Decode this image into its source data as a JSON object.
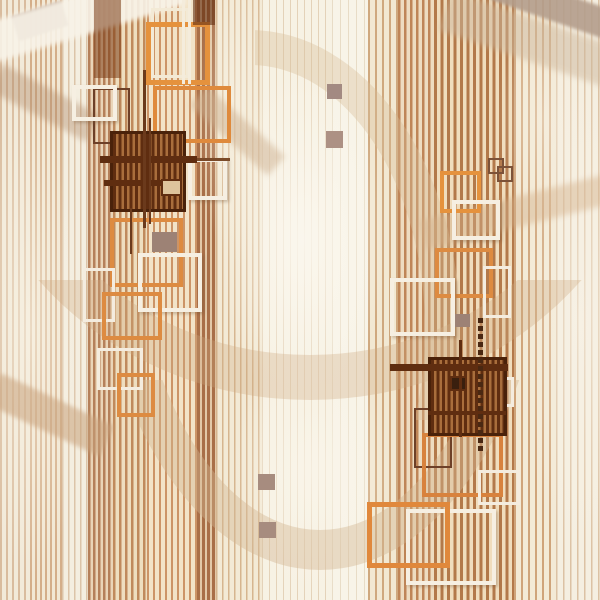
{
  "meta": {
    "title": "abstract-geometric-stripe-pattern",
    "width": 600,
    "height": 600,
    "background": "#f2e9d8"
  },
  "palette": {
    "cream": "#f2e9d8",
    "orange_frame": "#e0883c",
    "white_frame": "#f6efe2",
    "dark_brown": "#5f2d10",
    "plaid_stripe_a": "#5f2d10",
    "plaid_stripe_b": "#a96e3c",
    "plaid_border": "#4a220a",
    "taupe": "#a18878"
  },
  "stripes": [
    {
      "x": 0,
      "w": 30,
      "period": 6,
      "sw": 2,
      "stripe": "#d9bc9e",
      "base": "#f2ead9"
    },
    {
      "x": 30,
      "w": 32,
      "period": 5,
      "sw": 2,
      "stripe": "#d4ae89",
      "base": "#f2e8d4"
    },
    {
      "x": 62,
      "w": 26,
      "period": 6,
      "sw": 1.5,
      "stripe": "#dcc4a8",
      "base": "#f4eee0"
    },
    {
      "x": 88,
      "w": 25,
      "period": 5,
      "sw": 2.5,
      "stripe": "#b5805a",
      "base": "#ead5b8"
    },
    {
      "x": 113,
      "w": 34,
      "period": 6,
      "sw": 2.5,
      "stripe": "#c08a5c",
      "base": "#eedebf"
    },
    {
      "x": 147,
      "w": 50,
      "period": 6,
      "sw": 2,
      "stripe": "#cc9467",
      "base": "#f2e3c8"
    },
    {
      "x": 197,
      "w": 19,
      "period": 5,
      "sw": 3,
      "stripe": "#a96f48",
      "base": "#e3c9a8"
    },
    {
      "x": 216,
      "w": 46,
      "period": 6,
      "sw": 1.5,
      "stripe": "#d6b58f",
      "base": "#f3ead6"
    },
    {
      "x": 262,
      "w": 70,
      "period": 7,
      "sw": 1,
      "stripe": "#e4d2b8",
      "base": "#f7f2e4"
    },
    {
      "x": 332,
      "w": 36,
      "period": 8,
      "sw": 1,
      "stripe": "#e8dcc6",
      "base": "#f8f4e8"
    },
    {
      "x": 368,
      "w": 30,
      "period": 7,
      "sw": 2,
      "stripe": "#cfa87e",
      "base": "#f2e8d2"
    },
    {
      "x": 398,
      "w": 36,
      "period": 6,
      "sw": 2.5,
      "stripe": "#bf8557",
      "base": "#eedcc0"
    },
    {
      "x": 434,
      "w": 80,
      "period": 6.5,
      "sw": 3,
      "stripe": "#b3794a",
      "base": "#f0ddbd"
    },
    {
      "x": 514,
      "w": 42,
      "period": 7,
      "sw": 2,
      "stripe": "#cfa47a",
      "base": "#f3ead6"
    },
    {
      "x": 556,
      "w": 44,
      "period": 7,
      "sw": 1.5,
      "stripe": "#dcc2a4",
      "base": "#f5efe1"
    }
  ],
  "glows": [
    {
      "cx": 303,
      "cy": 240,
      "rx": 85,
      "ry": 175,
      "color": "#fbf7ee",
      "op": 0.9
    },
    {
      "cx": 312,
      "cy": 470,
      "rx": 80,
      "ry": 130,
      "color": "#faf5ea",
      "op": 0.75
    },
    {
      "cx": 30,
      "cy": 330,
      "rx": 55,
      "ry": 260,
      "color": "#f8f2e4",
      "op": 0.65
    },
    {
      "cx": 580,
      "cy": 320,
      "rx": 60,
      "ry": 240,
      "color": "#f8f2e6",
      "op": 0.6
    },
    {
      "cx": 238,
      "cy": 110,
      "rx": 40,
      "ry": 160,
      "color": "#f8f3e6",
      "op": 0.55
    },
    {
      "cx": 545,
      "cy": 120,
      "rx": 50,
      "ry": 120,
      "color": "#f7f0e2",
      "op": 0.5
    }
  ],
  "rings": [
    {
      "left": -40,
      "top": -250,
      "w": 700,
      "h": 650,
      "bw": 45,
      "color": "rgba(205,168,128,0.32)",
      "clip": {
        "x": 0,
        "y": 280,
        "w": 600,
        "h": 170
      }
    },
    {
      "left": 90,
      "top": -190,
      "w": 460,
      "h": 760,
      "bw": 40,
      "color": "rgba(210,180,146,0.42)",
      "clip": {
        "x": 140,
        "y": 380,
        "w": 460,
        "h": 220
      }
    },
    {
      "left": 40,
      "top": 30,
      "w": 420,
      "h": 600,
      "bw": 35,
      "color": "rgba(215,188,152,0.38)",
      "clip": {
        "x": 255,
        "y": 0,
        "w": 290,
        "h": 420
      }
    }
  ],
  "bands": [
    {
      "x": 14,
      "y": 8,
      "w": 52,
      "h": 26,
      "rot": -18,
      "color": "#ab9183",
      "op": 0.85,
      "blur": 1
    },
    {
      "x": -15,
      "y": -6,
      "w": 200,
      "h": 40,
      "rot": -17,
      "color": "#f8f3e8",
      "op": 0.9,
      "blur": 2
    },
    {
      "x": 492,
      "y": -8,
      "w": 130,
      "h": 30,
      "rot": 19,
      "color": "#b49e8c",
      "op": 0.9,
      "blur": 1.5
    },
    {
      "x": 440,
      "y": 20,
      "w": 190,
      "h": 42,
      "rot": 19,
      "color": "#cdb79c",
      "op": 0.5,
      "blur": 3
    },
    {
      "x": -10,
      "y": 88,
      "w": 110,
      "h": 30,
      "rot": 28,
      "color": "#b08a6a",
      "op": 0.4,
      "blur": 3
    },
    {
      "x": -12,
      "y": 398,
      "w": 125,
      "h": 34,
      "rot": 25,
      "color": "#c8a27c",
      "op": 0.55,
      "blur": 2
    },
    {
      "x": 185,
      "y": 118,
      "w": 105,
      "h": 26,
      "rot": 42,
      "color": "#cdb090",
      "op": 0.5,
      "blur": 3
    },
    {
      "x": 420,
      "y": 196,
      "w": 200,
      "h": 30,
      "rot": -14,
      "color": "#d3b08a",
      "op": 0.45,
      "blur": 3
    }
  ],
  "squares_outline": [
    {
      "x": 151,
      "y": 8,
      "w": 38,
      "h": 70,
      "bw": 3,
      "color": "#f3ead6",
      "shadow": false
    },
    {
      "x": 93,
      "y": 88,
      "w": 37,
      "h": 56,
      "bw": 2,
      "color": "#6d4028",
      "shadow": false
    },
    {
      "x": 72,
      "y": 85,
      "w": 45,
      "h": 36,
      "bw": 4,
      "color": "#f6efe2",
      "shadow": true
    },
    {
      "x": 146,
      "y": 22,
      "w": 64,
      "h": 63,
      "bw": 5,
      "color": "#e5923d",
      "shadow": false
    },
    {
      "x": 153,
      "y": 86,
      "w": 78,
      "h": 57,
      "bw": 4,
      "color": "#df8a3c",
      "shadow": false
    },
    {
      "x": 188,
      "y": 158,
      "w": 39,
      "h": 42,
      "bw": 4,
      "color": "#f6efe2",
      "shadow": true
    },
    {
      "x": 110,
      "y": 218,
      "w": 73,
      "h": 69,
      "bw": 4,
      "color": "#dd8b41",
      "shadow": false
    },
    {
      "x": 83,
      "y": 268,
      "w": 32,
      "h": 54,
      "bw": 3,
      "color": "#f4ecdf",
      "shadow": false
    },
    {
      "x": 138,
      "y": 253,
      "w": 64,
      "h": 59,
      "bw": 4,
      "color": "#f6efe2",
      "shadow": true
    },
    {
      "x": 102,
      "y": 292,
      "w": 60,
      "h": 48,
      "bw": 4,
      "color": "#dd8b41",
      "shadow": false
    },
    {
      "x": 97,
      "y": 348,
      "w": 46,
      "h": 42,
      "bw": 3,
      "color": "#f4ecdf",
      "shadow": false
    },
    {
      "x": 117,
      "y": 373,
      "w": 38,
      "h": 44,
      "bw": 4,
      "color": "#dd8b41",
      "shadow": false
    },
    {
      "x": 440,
      "y": 171,
      "w": 41,
      "h": 42,
      "bw": 4,
      "color": "#e5923d",
      "shadow": false
    },
    {
      "x": 452,
      "y": 200,
      "w": 48,
      "h": 40,
      "bw": 4,
      "color": "#f6efe2",
      "shadow": true
    },
    {
      "x": 488,
      "y": 158,
      "w": 16,
      "h": 16,
      "bw": 2,
      "color": "#7c5238",
      "shadow": false
    },
    {
      "x": 497,
      "y": 166,
      "w": 16,
      "h": 16,
      "bw": 2,
      "color": "#7c5238",
      "shadow": false
    },
    {
      "x": 435,
      "y": 248,
      "w": 58,
      "h": 50,
      "bw": 4,
      "color": "#dd8b41",
      "shadow": false
    },
    {
      "x": 483,
      "y": 266,
      "w": 28,
      "h": 52,
      "bw": 3,
      "color": "#f4ecdf",
      "shadow": false
    },
    {
      "x": 390,
      "y": 278,
      "w": 65,
      "h": 58,
      "bw": 4,
      "color": "#f6efe2",
      "shadow": true
    },
    {
      "x": 414,
      "y": 408,
      "w": 38,
      "h": 60,
      "bw": 2,
      "color": "#6d4028",
      "shadow": false
    },
    {
      "x": 492,
      "y": 377,
      "w": 22,
      "h": 30,
      "bw": 3,
      "color": "#f4ecdf",
      "shadow": false
    },
    {
      "x": 422,
      "y": 433,
      "w": 81,
      "h": 64,
      "bw": 4,
      "color": "#d8823d",
      "shadow": false
    },
    {
      "x": 478,
      "y": 470,
      "w": 42,
      "h": 35,
      "bw": 3,
      "color": "#f4ecdf",
      "shadow": false
    },
    {
      "x": 406,
      "y": 509,
      "w": 90,
      "h": 76,
      "bw": 4,
      "color": "#f6efe2",
      "shadow": true
    },
    {
      "x": 367,
      "y": 502,
      "w": 83,
      "h": 66,
      "bw": 5,
      "color": "#e0883c",
      "shadow": false
    }
  ],
  "squares_filled": [
    {
      "x": 327,
      "y": 84,
      "w": 15,
      "h": 15,
      "color": "#a38a82"
    },
    {
      "x": 326,
      "y": 131,
      "w": 17,
      "h": 17,
      "color": "#ad9184"
    },
    {
      "x": 152,
      "y": 232,
      "w": 25,
      "h": 20,
      "color": "#9d8275"
    },
    {
      "x": 455,
      "y": 314,
      "w": 15,
      "h": 13,
      "color": "#9d8275"
    },
    {
      "x": 258,
      "y": 474,
      "w": 17,
      "h": 16,
      "color": "#a78c7f"
    },
    {
      "x": 259,
      "y": 522,
      "w": 17,
      "h": 16,
      "color": "#a78c7f"
    }
  ],
  "plaids": [
    {
      "x": 110,
      "y": 131,
      "w": 76,
      "h": 81,
      "inner": {
        "x": 48,
        "y": 45,
        "w": 21,
        "h": 17,
        "fill": "#ddc49c"
      }
    },
    {
      "x": 428,
      "y": 357,
      "w": 79,
      "h": 79,
      "inner": {
        "x": 19,
        "y": 16,
        "w": 17,
        "h": 15,
        "fill": "#3a1f0e"
      }
    }
  ],
  "lines": [
    {
      "x": 100,
      "y": 156,
      "w": 97,
      "h": 7,
      "color": "#5f2d10"
    },
    {
      "x": 104,
      "y": 180,
      "w": 58,
      "h": 6,
      "color": "#5f2d10"
    },
    {
      "x": 143,
      "y": 70,
      "w": 3,
      "h": 158,
      "color": "#6b3a1c"
    },
    {
      "x": 149,
      "y": 118,
      "w": 2,
      "h": 106,
      "color": "#6b3a1c"
    },
    {
      "x": 130,
      "y": 208,
      "w": 2,
      "h": 46,
      "color": "#6b3a1c"
    },
    {
      "x": 197,
      "y": 158,
      "w": 33,
      "h": 3,
      "color": "#7a4a28"
    },
    {
      "x": 182,
      "y": 0,
      "w": 2.5,
      "h": 84,
      "color": "#f4ecdc"
    },
    {
      "x": 188,
      "y": 0,
      "w": 2.5,
      "h": 84,
      "color": "#f4ecdc"
    },
    {
      "x": 390,
      "y": 364,
      "w": 118,
      "h": 7,
      "color": "#5f2d10"
    },
    {
      "x": 428,
      "y": 411,
      "w": 78,
      "h": 4,
      "color": "#5f2d10"
    },
    {
      "x": 459,
      "y": 340,
      "w": 3,
      "h": 97,
      "color": "#5f2d10"
    },
    {
      "x": 94,
      "y": 0,
      "w": 27,
      "h": 78,
      "color": "rgba(122,60,22,0.55)"
    },
    {
      "x": 193,
      "y": 0,
      "w": 22,
      "h": 25,
      "color": "rgba(96,45,16,0.6)"
    }
  ],
  "chains": [
    {
      "x": 478,
      "y": 318,
      "len": 130,
      "size": 5,
      "gap": 8,
      "color": "#4a2812"
    }
  ]
}
